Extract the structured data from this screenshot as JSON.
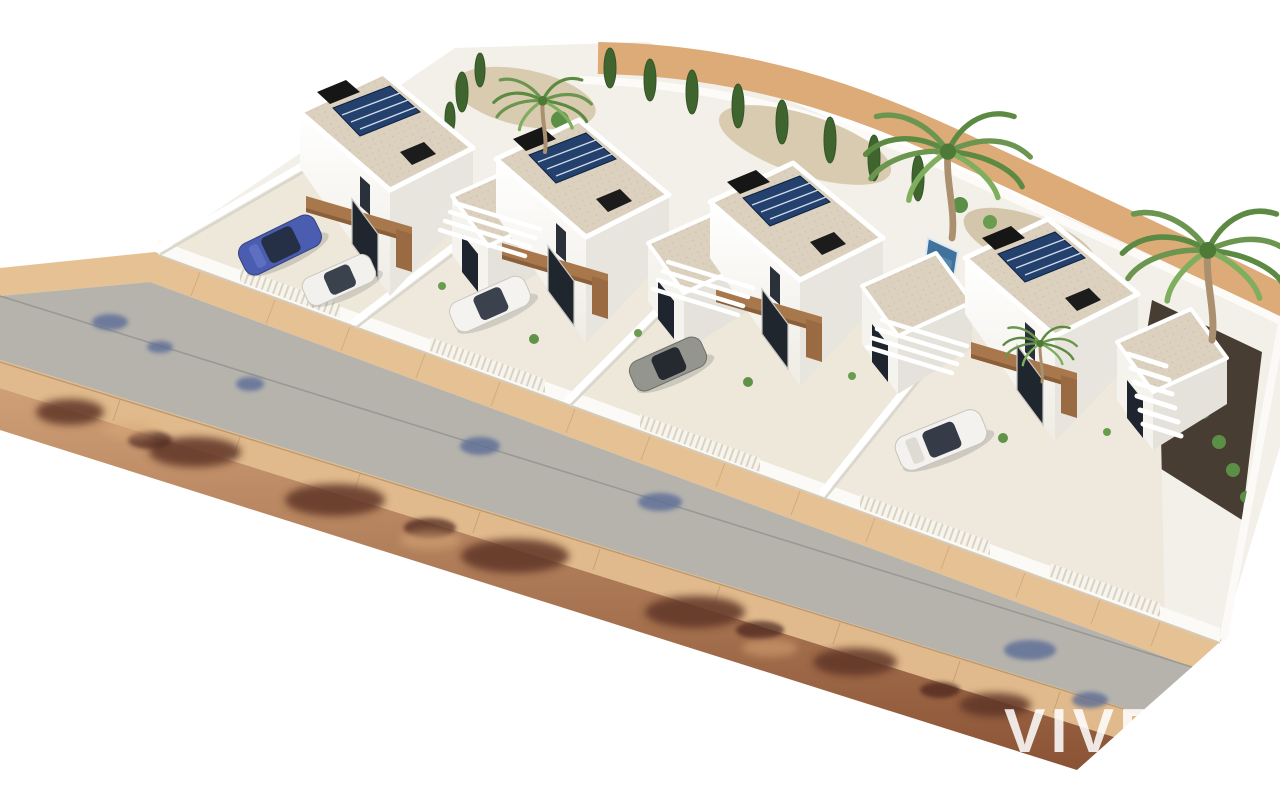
{
  "meta": {
    "type": "3d-architectural-render",
    "description": "Aerial 3D visualisation of a new-build development: a diagonal row of four modern white two-storey villas with flat gravel roofs, rooftop solar panels, black chimney boxes, timber pergolas, glazed doors, private walled front yards with parked cars and slatted fences, a small pool, palm and cypress trees, gravel gardens, and a street with tan sidewalks and a dirt verge covered by tree shadows. White watermark logo at bottom right."
  },
  "watermark": {
    "logo_text": "VIVE",
    "tagline_visible": "EST",
    "color": "#ffffff"
  },
  "scene": {
    "villa_count": 4,
    "features": [
      "flat gravel roofs",
      "rooftop solar panels",
      "black roof chimneys",
      "timber pergolas",
      "walled front yards",
      "slatted fences",
      "driveways with parked cars",
      "private pool",
      "palm trees",
      "cypress trees",
      "dark gravel side garden",
      "street with sidewalks",
      "dirt verge with tree shadows",
      "white staircase slats"
    ],
    "cars": [
      {
        "name": "car-blue",
        "color": "#4a5db0"
      },
      {
        "name": "car-white-1",
        "color": "#f2f1ed"
      },
      {
        "name": "car-white-2",
        "color": "#f4f3f0"
      },
      {
        "name": "car-gray",
        "color": "#95958f"
      },
      {
        "name": "car-white-3",
        "color": "#f3f2ef"
      }
    ],
    "palette": {
      "background": "#ffffff",
      "wall_white": "#f9f8f4",
      "wall_shade": "#e7e5de",
      "roof_gravel": "#dcd1be",
      "timber": "#a8784c",
      "solar_panel": "#24416e",
      "road": "#b6b3ad",
      "sidewalk_upper": "#e6c193",
      "sidewalk_lower": "#e0ba8c",
      "dirt_top": "#cfa077",
      "dirt_bottom": "#8a5335",
      "shadow_brown": "#5e3426",
      "shadow_foliage_blue": "#5b6d96",
      "palm_green": "#6c9550",
      "cypress_green": "#3f642e",
      "pool_blue": "#41729c"
    }
  }
}
